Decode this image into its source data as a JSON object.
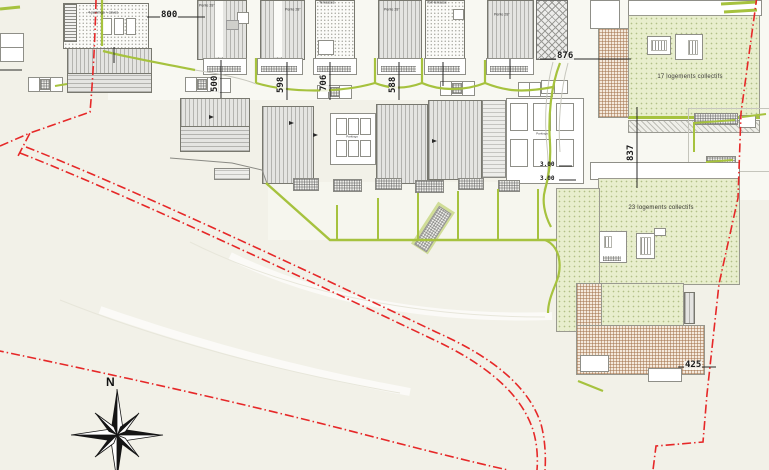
{
  "plan_labels": {
    "dim_800": "800",
    "dim_500": "500",
    "dim_598": "598",
    "dim_706": "706",
    "dim_588": "588",
    "dim_876": "876",
    "dim_837": "837",
    "dim_425": "425",
    "dim_300": "3.00"
  },
  "annotations": {
    "pente28": "Pente 28°",
    "terrasses": "Terrasses",
    "toit_terrasse": "Toit-terrasse",
    "garages": "4 parkings + caves",
    "parkings": "Parkings",
    "block17": "17 logements collectifs",
    "block23": "23 logements collectifs"
  },
  "compass": {
    "north": "N"
  },
  "colors": {
    "boundary": "#e62828",
    "green_line": "#a6c23e",
    "green_fill": "#e8eecd",
    "tan": "#f4e9dc"
  }
}
